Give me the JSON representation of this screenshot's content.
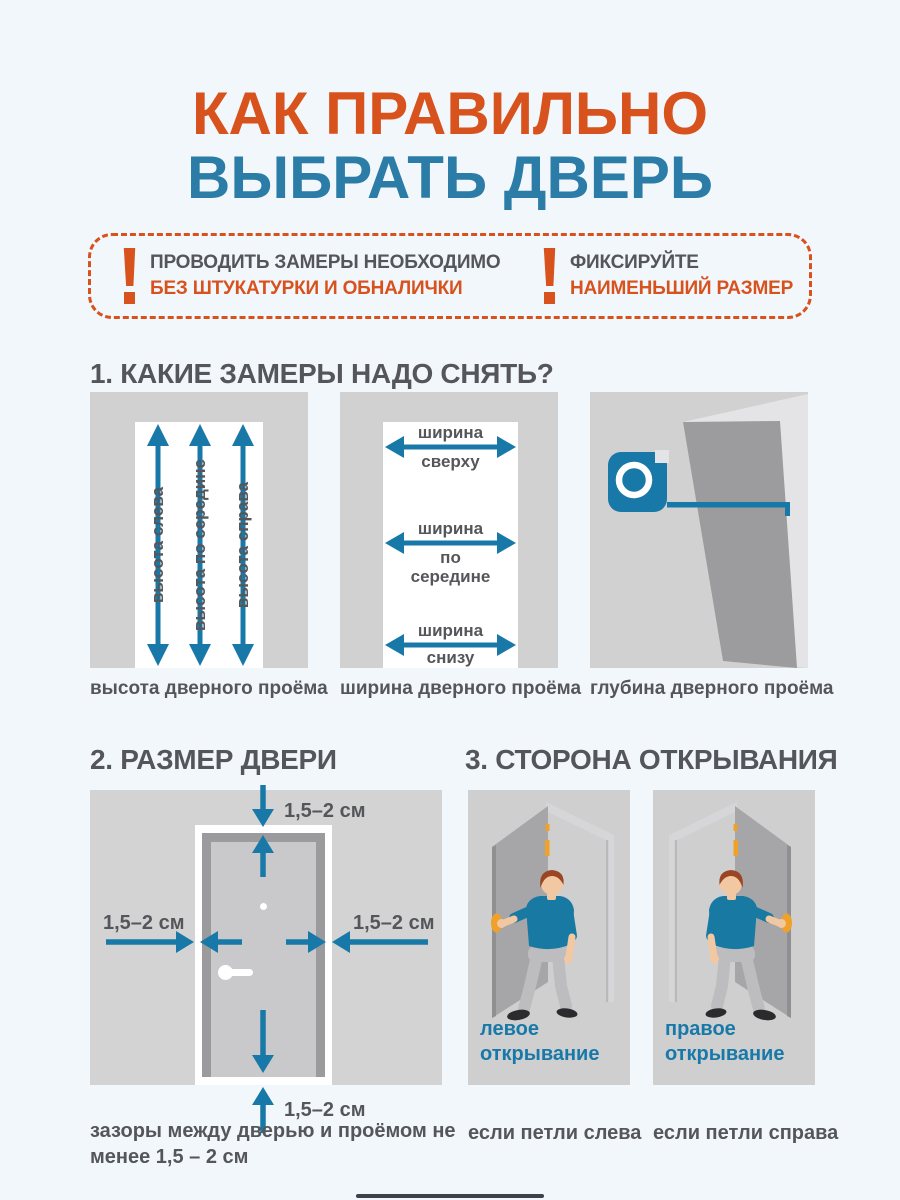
{
  "title": {
    "line1": "КАК ПРАВИЛЬНО",
    "line2": "ВЫБРАТЬ ДВЕРЬ"
  },
  "notice": {
    "items": [
      {
        "line1": "ПРОВОДИТЬ ЗАМЕРЫ НЕОБХОДИМО",
        "line2": "БЕЗ ШТУКАТУРКИ И ОБНАЛИЧКИ"
      },
      {
        "line1": "ФИКСИРУЙТЕ",
        "line2": "НАИМЕНЬШИЙ РАЗМЕР"
      }
    ]
  },
  "sections": {
    "s1": {
      "heading": "1. КАКИЕ ЗАМЕРЫ НАДО СНЯТЬ?",
      "height_arrows": [
        "высота слева",
        "высота по середине",
        "высота справа"
      ],
      "width_arrows": [
        {
          "above": "ширина",
          "below": "сверху"
        },
        {
          "above": "ширина",
          "below": "по середине"
        },
        {
          "above": "ширина",
          "below": "снизу"
        }
      ],
      "captions": [
        "высота дверного проёма",
        "ширина дверного проёма",
        "глубина дверного проёма"
      ]
    },
    "s2": {
      "heading": "2. РАЗМЕР ДВЕРИ",
      "gap_label": "1,5–2 см",
      "caption": "зазоры между дверью и проёмом не менее 1,5 – 2 см"
    },
    "s3": {
      "heading": "3. СТОРОНА ОТКРЫВАНИЯ",
      "left": {
        "label_line1": "левое",
        "label_line2": "открывание",
        "caption": "если петли слева"
      },
      "right": {
        "label_line1": "правое",
        "label_line2": "открывание",
        "caption": "если петли справа"
      }
    }
  },
  "colors": {
    "accent_orange": "#d8521d",
    "accent_blue": "#2b7ca7",
    "diagram_teal": "#1879a8",
    "text_gray": "#55565a"
  }
}
